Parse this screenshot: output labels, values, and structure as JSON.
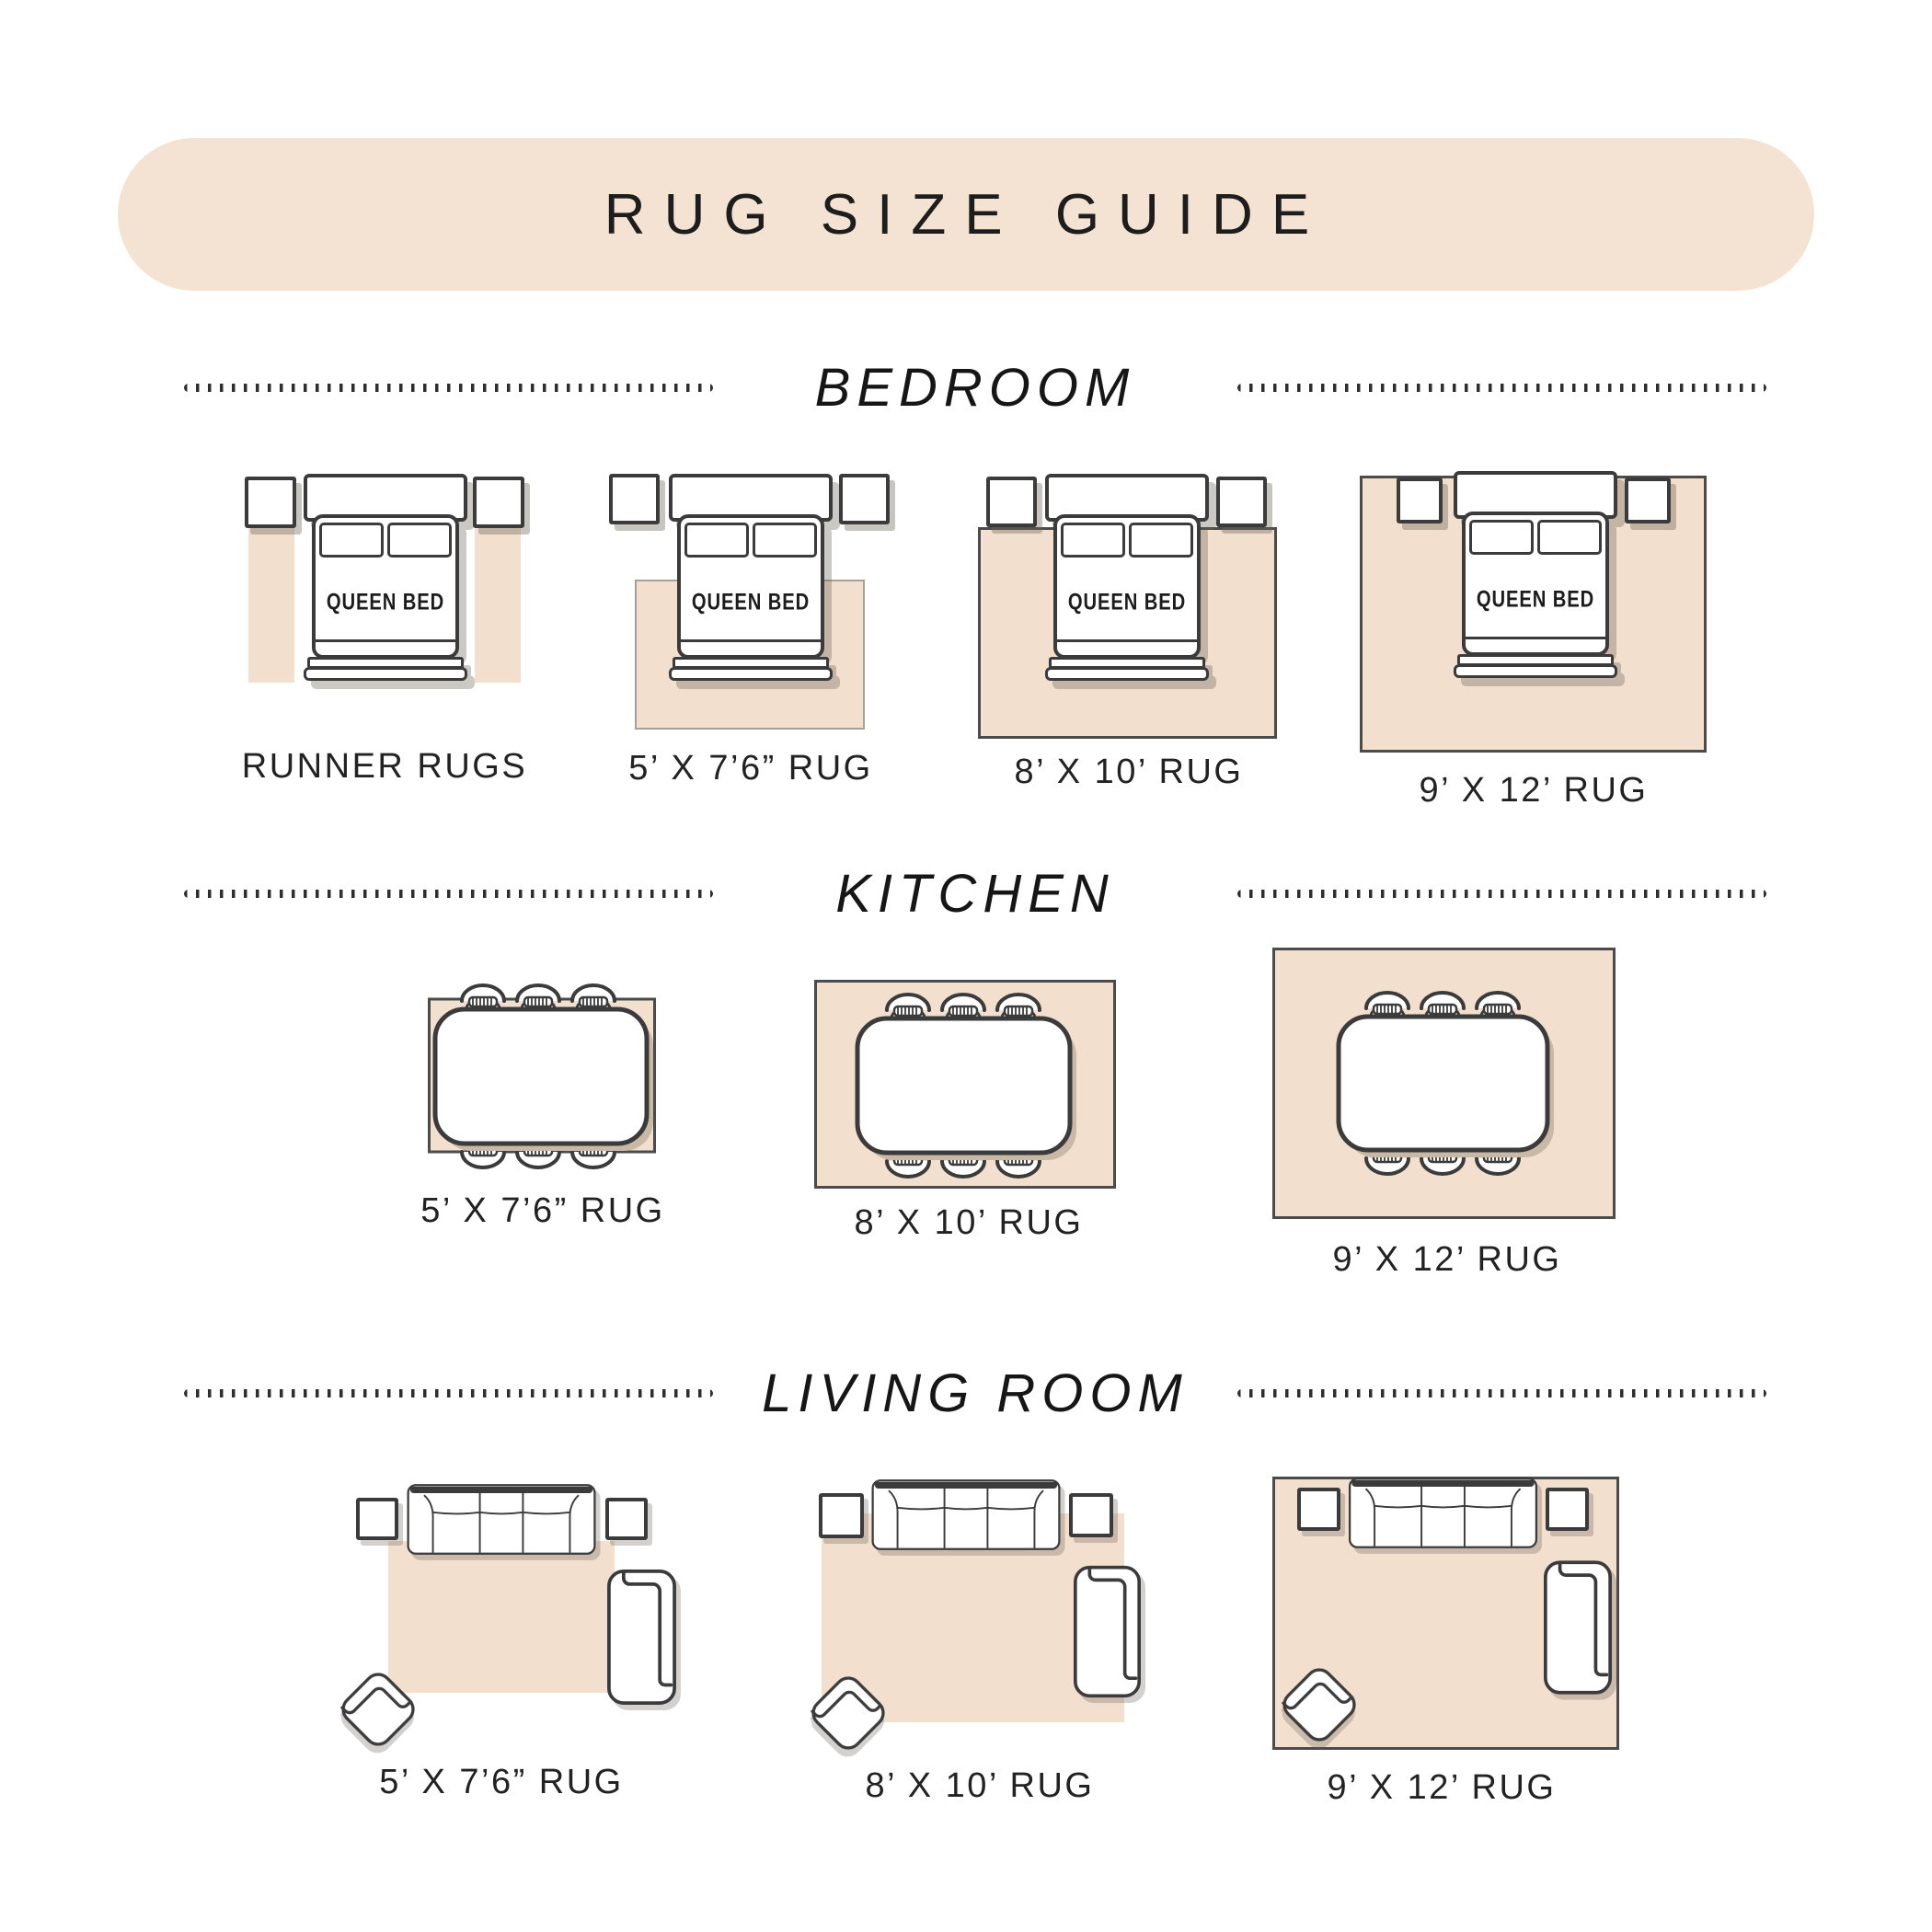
{
  "title": {
    "text": "RUG SIZE GUIDE"
  },
  "colors": {
    "banner": "#f4e3d2",
    "rug": "#f2dfce",
    "outline": "#3b3b3b",
    "text": "#1d1d1d"
  },
  "bed_label": "QUEEN BED",
  "sections": {
    "bedroom": {
      "label": "BEDROOM",
      "items": [
        {
          "label": "RUNNER RUGS"
        },
        {
          "label": "5’ X 7’6” RUG"
        },
        {
          "label": "8’ X 10’ RUG"
        },
        {
          "label": "9’ X 12’ RUG"
        }
      ]
    },
    "kitchen": {
      "label": "KITCHEN",
      "items": [
        {
          "label": "5’ X 7’6” RUG"
        },
        {
          "label": "8’ X 10’ RUG"
        },
        {
          "label": "9’ X 12’ RUG"
        }
      ]
    },
    "living_room": {
      "label": "LIVING ROOM",
      "items": [
        {
          "label": "5’ X 7’6” RUG"
        },
        {
          "label": "8’ X 10’ RUG"
        },
        {
          "label": "9’ X 12’ RUG"
        }
      ]
    }
  }
}
